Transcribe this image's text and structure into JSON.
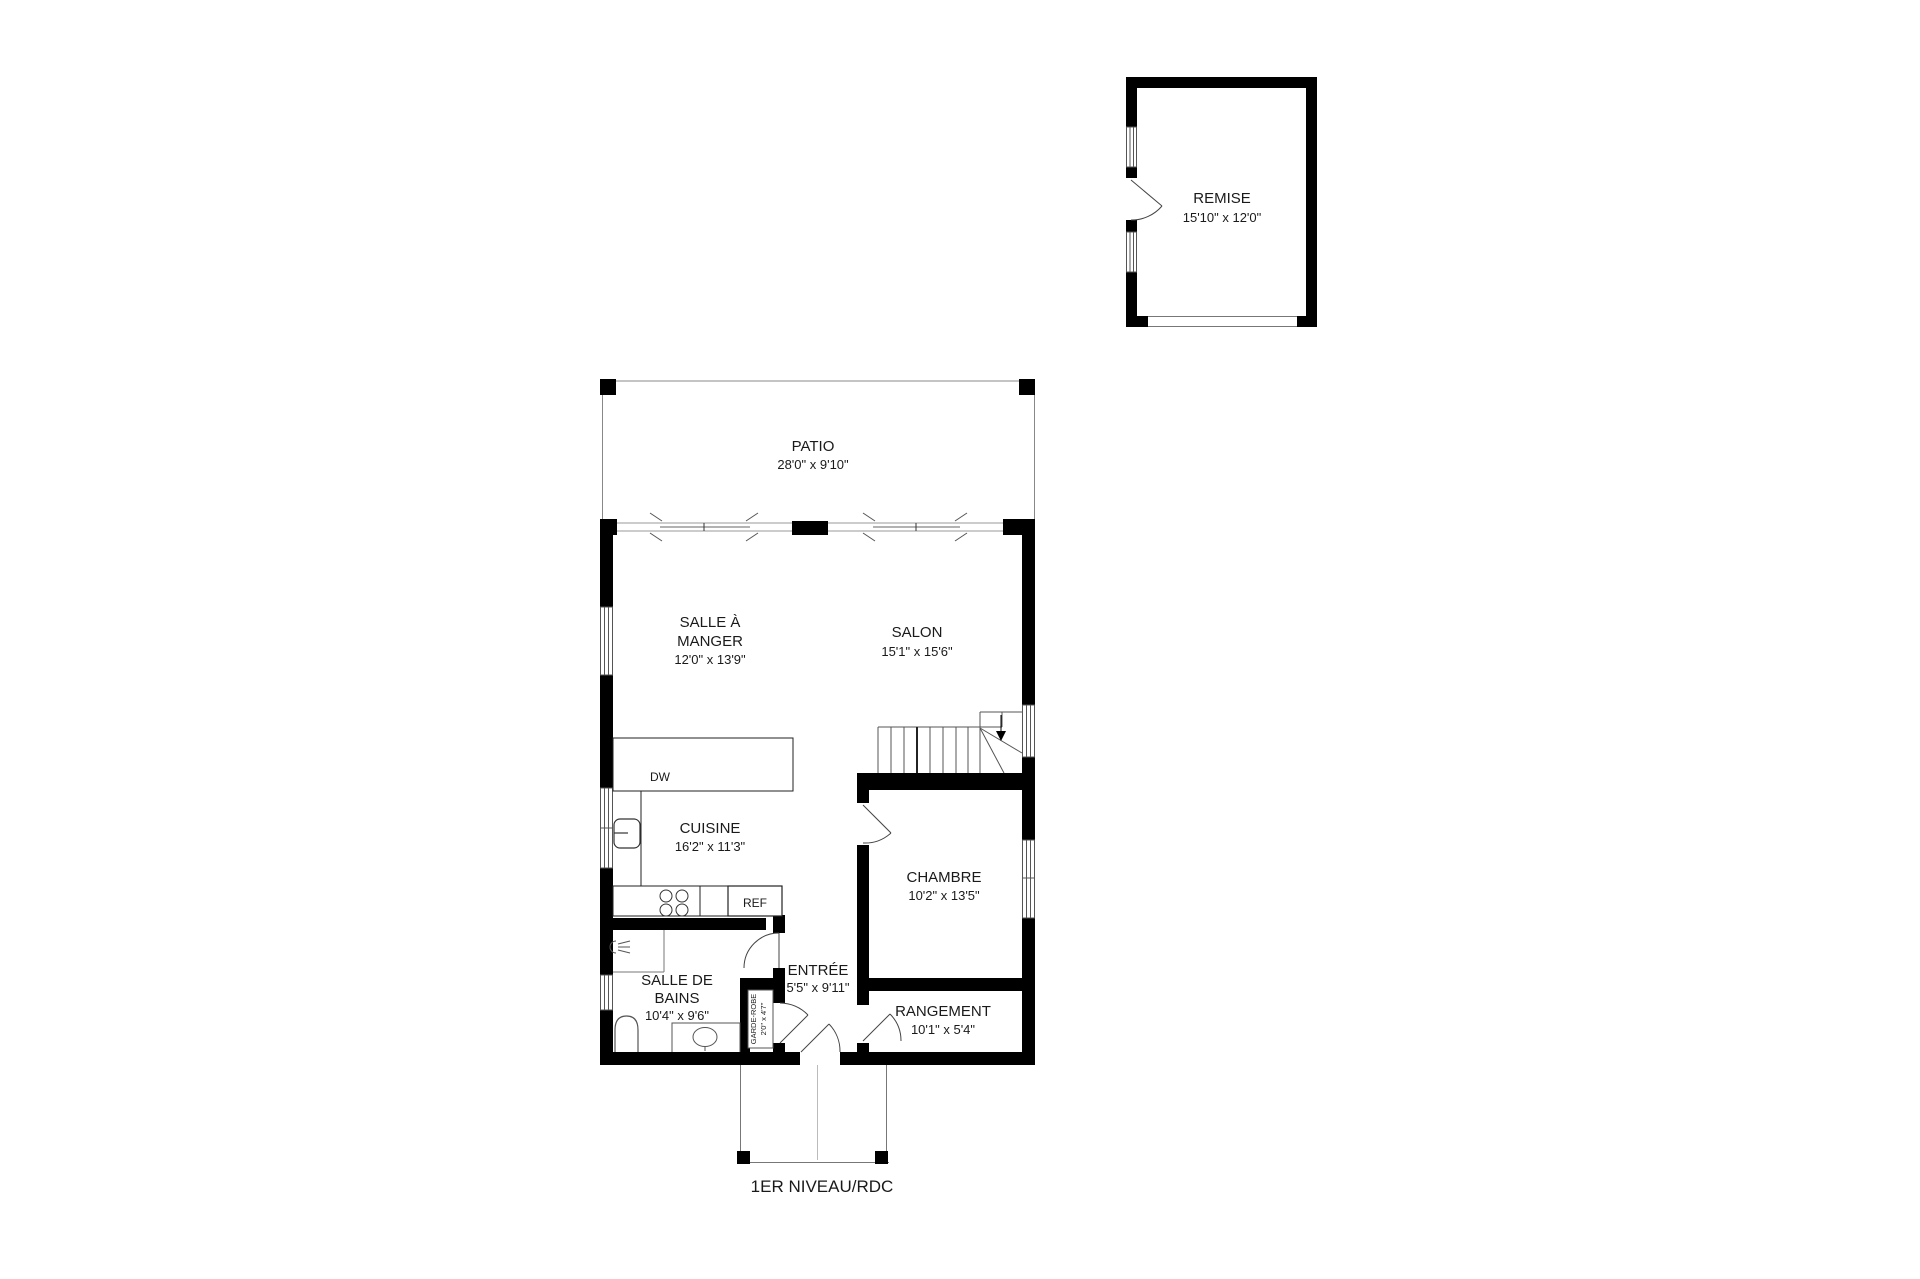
{
  "rooms": {
    "remise": {
      "name": "REMISE",
      "dims": "15'10\" x 12'0\""
    },
    "patio": {
      "name": "PATIO",
      "dims": "28'0\" x 9'10\""
    },
    "salle_a_manger": {
      "name_line1": "SALLE À",
      "name_line2": "MANGER",
      "dims": "12'0\" x 13'9\""
    },
    "salon": {
      "name": "SALON",
      "dims": "15'1\" x 15'6\""
    },
    "cuisine": {
      "name": "CUISINE",
      "dims": "16'2\" x 11'3\""
    },
    "chambre": {
      "name": "CHAMBRE",
      "dims": "10'2\" x 13'5\""
    },
    "salle_de_bains": {
      "name_line1": "SALLE DE",
      "name_line2": "BAINS",
      "dims": "10'4\" x 9'6\""
    },
    "entree": {
      "name": "ENTRÉE",
      "dims": "5'5\" x 9'11\""
    },
    "rangement": {
      "name": "RANGEMENT",
      "dims": "10'1\" x 5'4\""
    },
    "garde_robe": {
      "name": "GARDE-ROBE",
      "dims": "2'0\" x 4'7\""
    }
  },
  "appliances": {
    "dishwasher": "DW",
    "refrigerator": "REF"
  },
  "footer": {
    "level_label": "1ER NIVEAU/RDC"
  },
  "colors": {
    "wall": "#000000",
    "background": "#ffffff",
    "fixture_line": "#6e6e6e"
  }
}
